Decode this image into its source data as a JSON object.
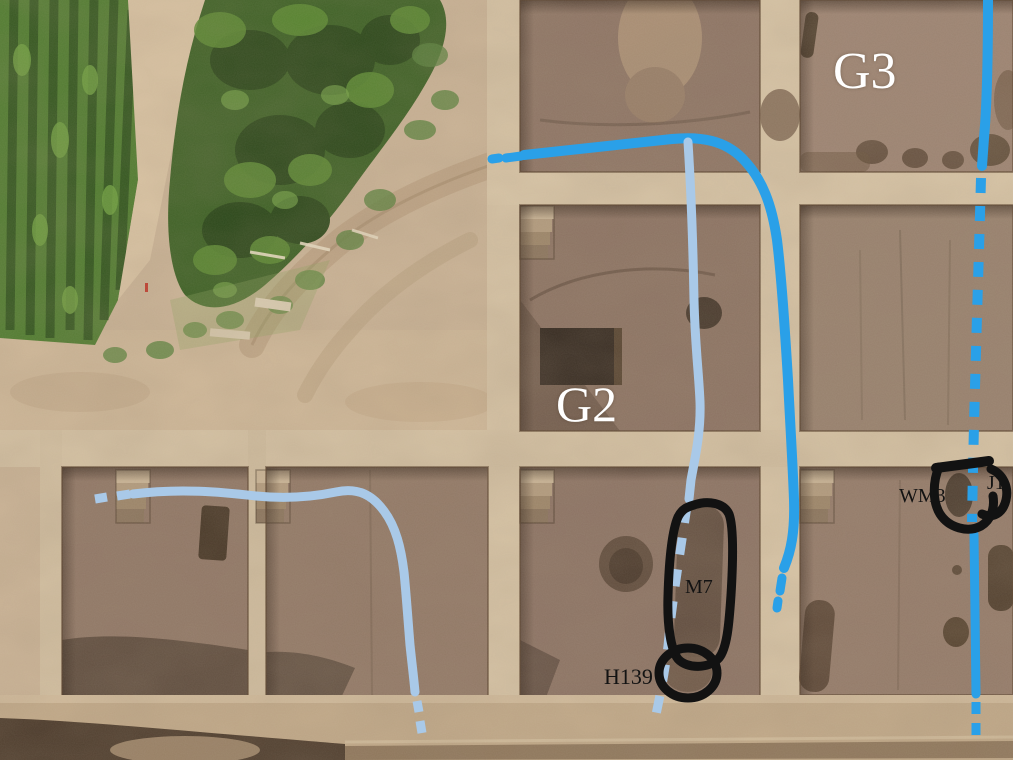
{
  "image": {
    "description": "Aerial drone photograph of an archaeological excavation site grid with annotated ditch lines and feature outlines",
    "labels": {
      "g3": {
        "text": "G3",
        "color": "#ffffff"
      },
      "g2": {
        "text": "G2",
        "color": "#ffffff"
      },
      "wm3": {
        "text": "WM3",
        "color": "#131313"
      },
      "j1": {
        "text": "J1",
        "color": "#131313"
      },
      "m7": {
        "text": "M7",
        "color": "#131313"
      },
      "h139": {
        "text": "H139",
        "color": "#131313"
      }
    },
    "annotation_lines": [
      {
        "name": "blue-ditch-line-top",
        "style": "solid-with-dashed-ends",
        "color": "#2aa0e8"
      },
      {
        "name": "blue-ditch-line-right",
        "style": "solid-then-dashed",
        "color": "#2aa0e8"
      },
      {
        "name": "lightblue-ditch-left",
        "style": "solid-with-dashed-ends",
        "color": "#a9c9e8"
      },
      {
        "name": "lightblue-ditch-branch",
        "style": "solid-then-dashed",
        "color": "#a9c9e8"
      }
    ],
    "feature_outline_color": "#121212"
  }
}
